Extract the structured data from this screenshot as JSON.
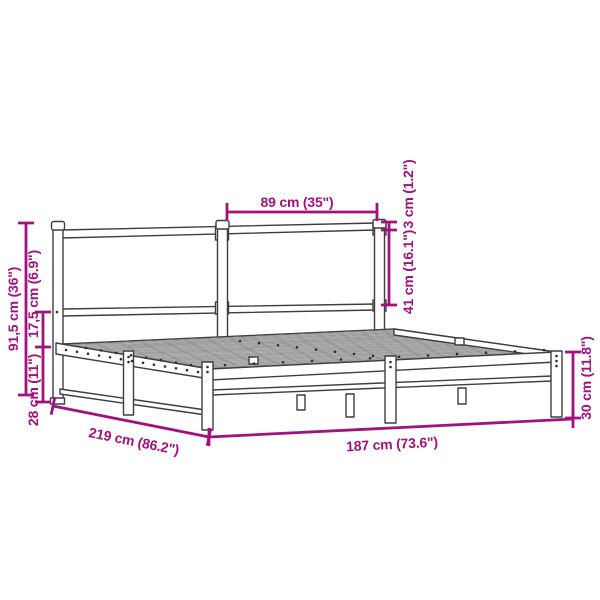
{
  "diagram": {
    "subject": "metal bed frame with headboard",
    "colors": {
      "annotation": "#a1127d",
      "frame_outline": "#3e3e3e",
      "background": "#ffffff"
    },
    "dimensions": {
      "headboard_section_width": "89 cm (35\")",
      "headboard_top_rail_thickness": "3 cm (1.2\")",
      "headboard_rail_gap": "41 cm (16.1\")",
      "headboard_height": "91,5 cm (36\")",
      "frame_to_rail_gap": "17,5 cm (6.9\")",
      "under_bed_clearance": "28 cm (11\")",
      "total_length": "219 cm (86.2\")",
      "total_width": "187 cm (73.6\")",
      "frame_side_height": "30 cm (11.8\")"
    }
  }
}
